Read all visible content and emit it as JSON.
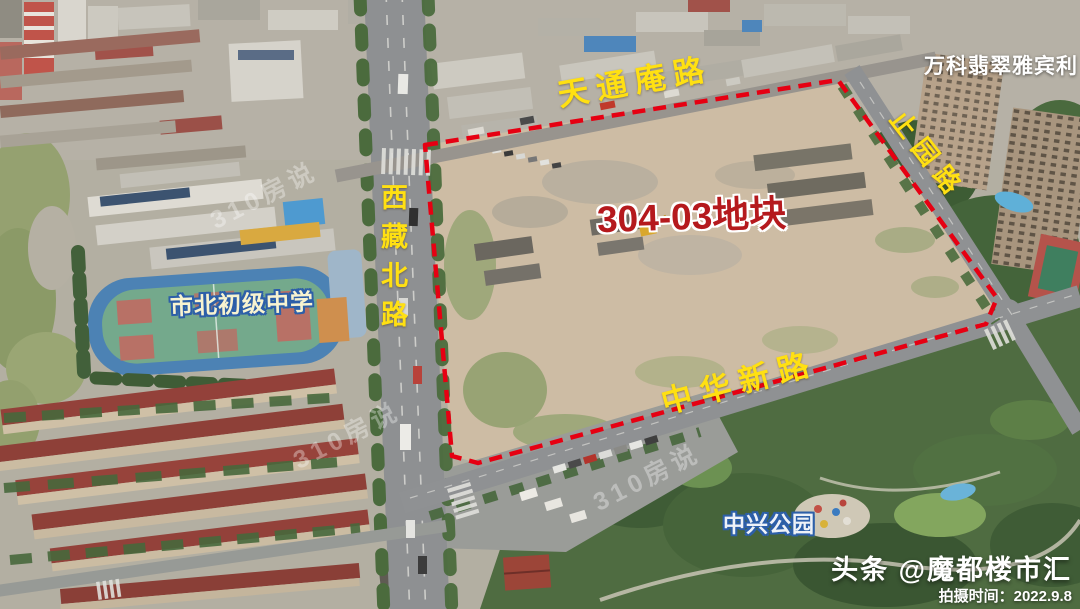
{
  "labels": {
    "road_top": "天通庵路",
    "road_left": "西藏北路",
    "road_right": "止园路",
    "road_bottom": "中华新路",
    "parcel": "304-03地块",
    "school": "市北初级中学",
    "park": "中兴公园",
    "residence": "万科翡翠雅宾利"
  },
  "watermark": {
    "text": "310房说"
  },
  "credits": {
    "source": "头条 @魔都楼市汇",
    "shot_time": "拍摄时间：2022.9.8"
  },
  "colors": {
    "boundary_red": "#e60012",
    "road_label_yellow": "#ffe012",
    "parcel_label_red": "#b5191d",
    "parcel_label_outline": "#ffffff",
    "blue_outline_labels": "#2d5fa8"
  }
}
